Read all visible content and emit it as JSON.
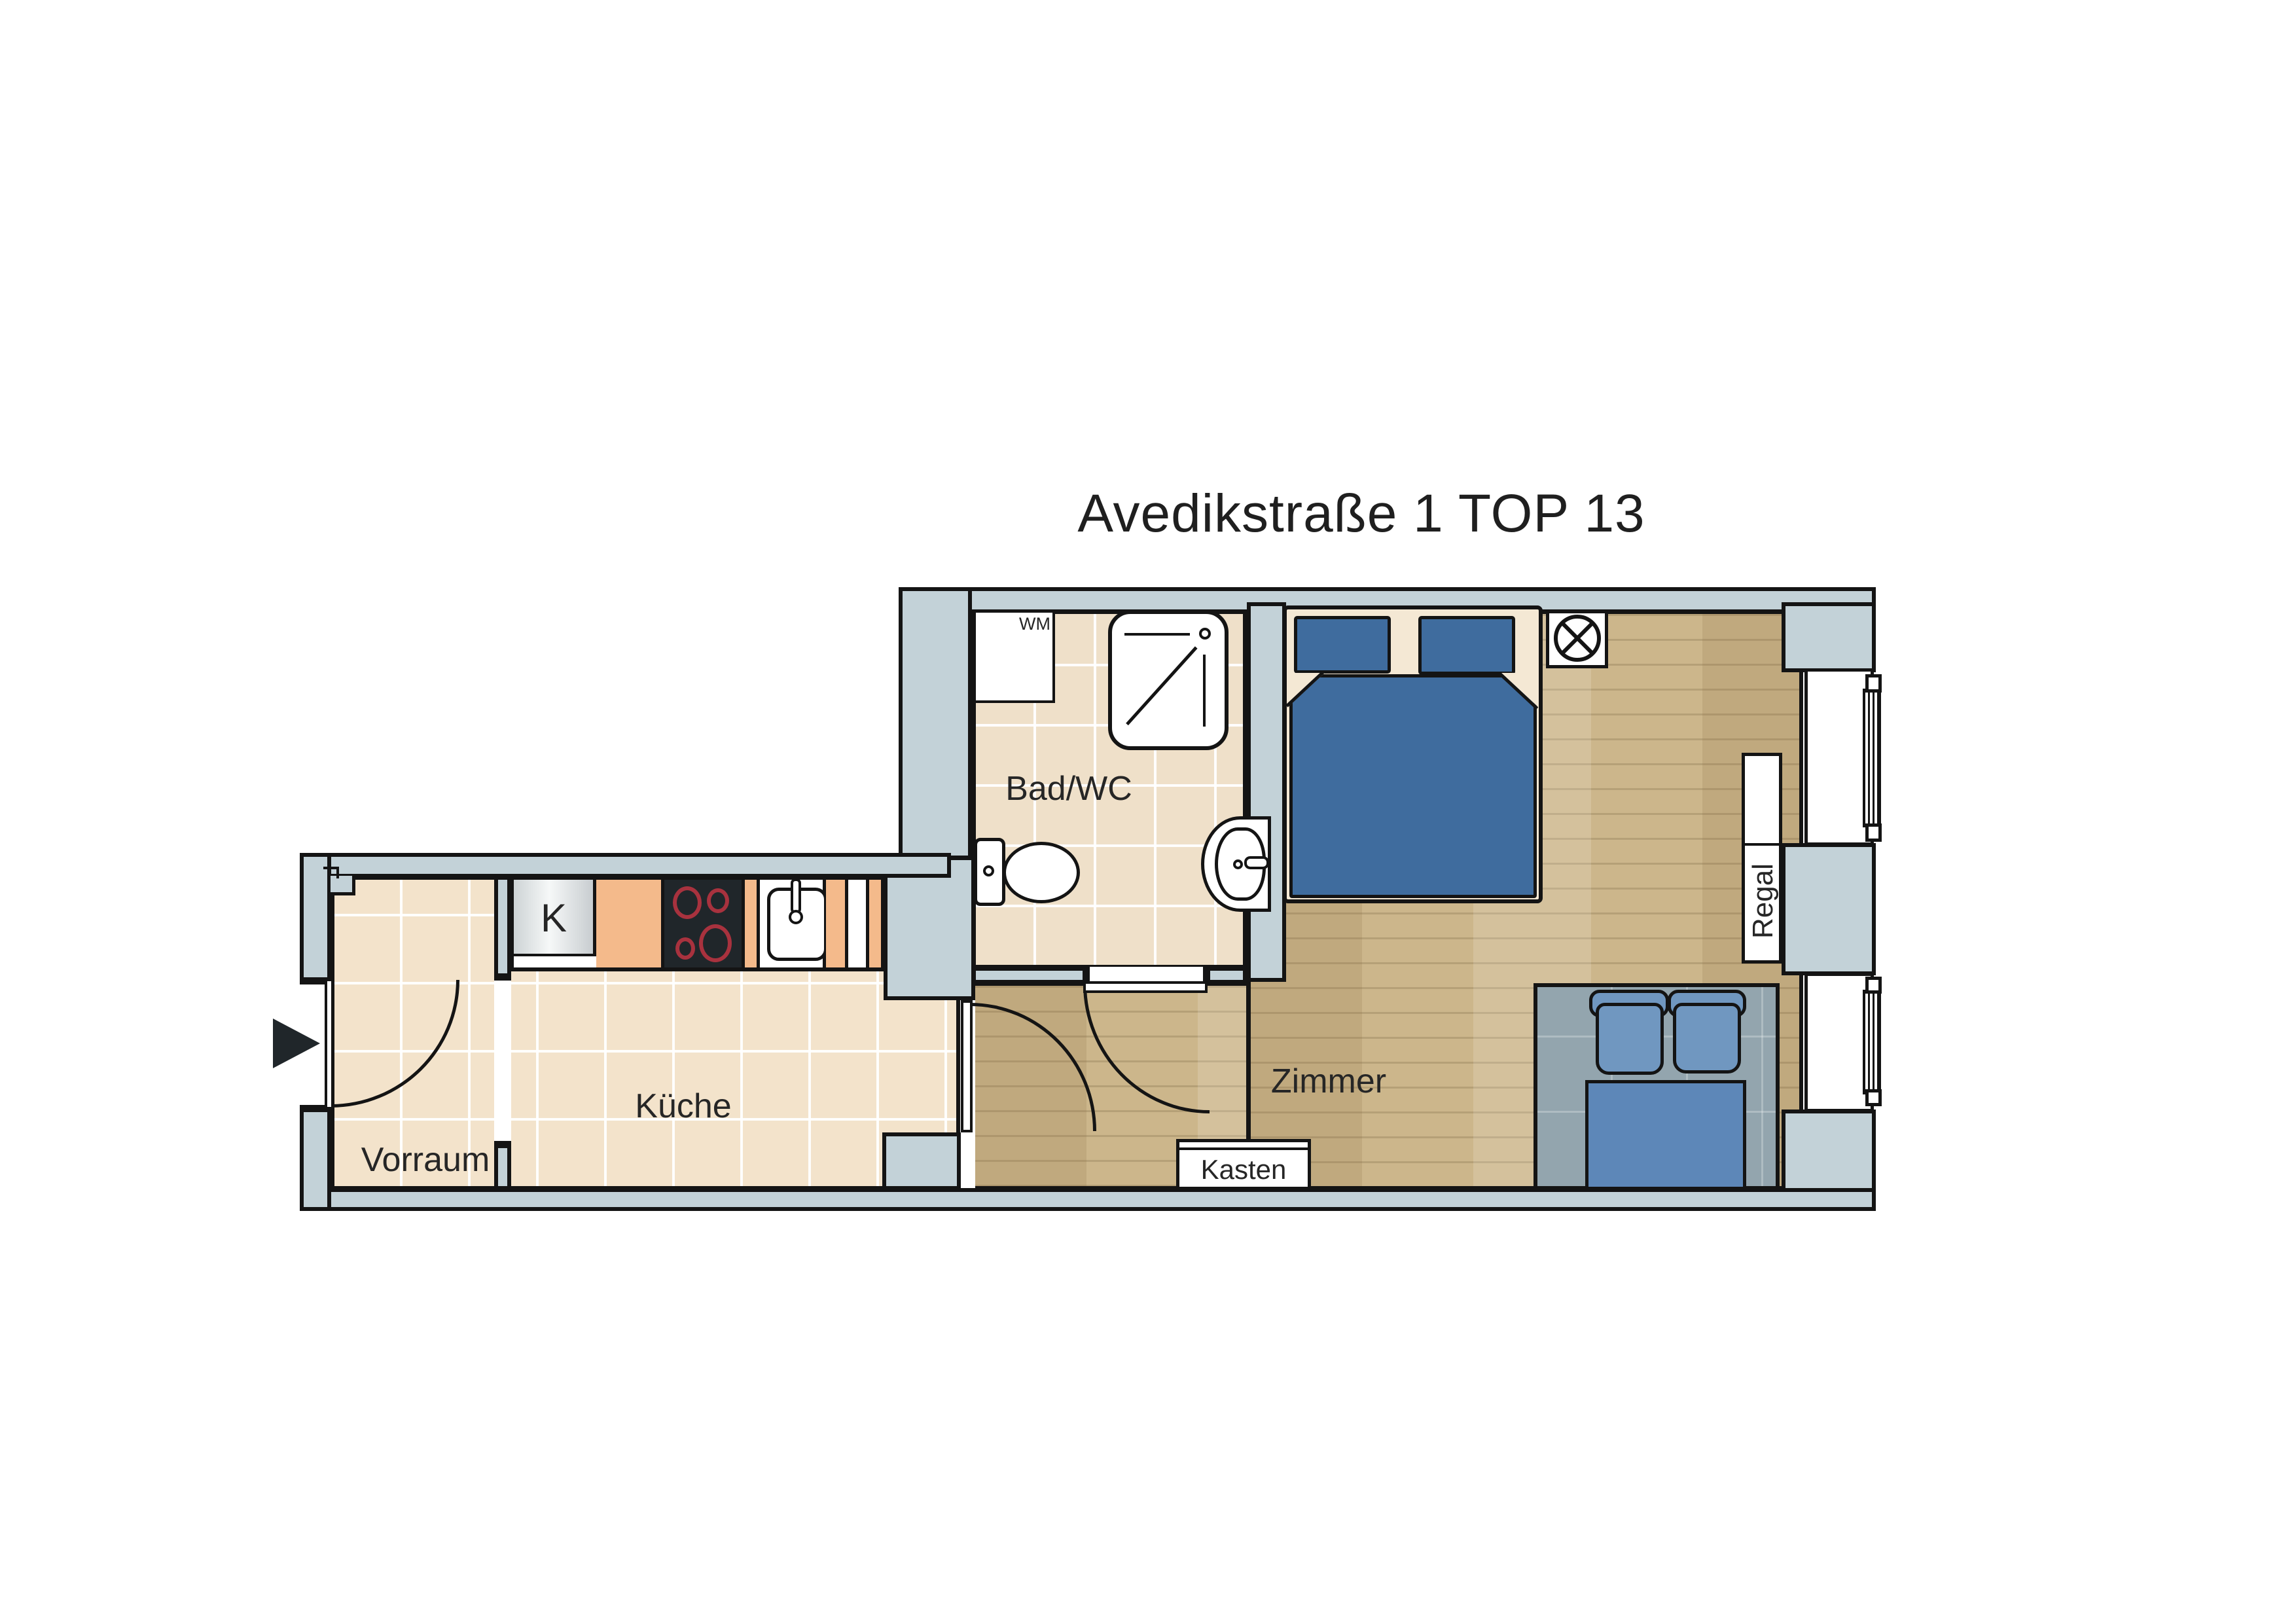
{
  "title": "Avedikstraße 1 TOP 13",
  "rooms": {
    "vorraum": {
      "label": "Vorraum"
    },
    "kueche": {
      "label": "Küche"
    },
    "bad_wc": {
      "label": "Bad/WC"
    },
    "zimmer": {
      "label": "Zimmer"
    }
  },
  "fixtures": {
    "washing_machine_label": "WM",
    "fridge_label": "K",
    "wardrobe_label": "Kasten",
    "shelf_label": "Regal"
  },
  "icons": {
    "entrance_arrow": "right-filled-triangle",
    "ceiling_light": "circle-with-x",
    "door_swing": "quarter-arc",
    "radiator": "striped-bar"
  },
  "colors": {
    "wall_fill": "#c3d2d8",
    "tile_floor": "#f3e3cb",
    "wood_floor": "#ccb68b",
    "bed_blue": "#3f6c9e",
    "sofa_cushion_blue": "#7097c0",
    "sofa_seat_blue": "#5d87b8",
    "rug_gray": "#93a5ae",
    "counter_orange": "#f4ba8b",
    "stove_black": "#20262a",
    "burner_red": "#a8323e",
    "outline": "#141414"
  }
}
